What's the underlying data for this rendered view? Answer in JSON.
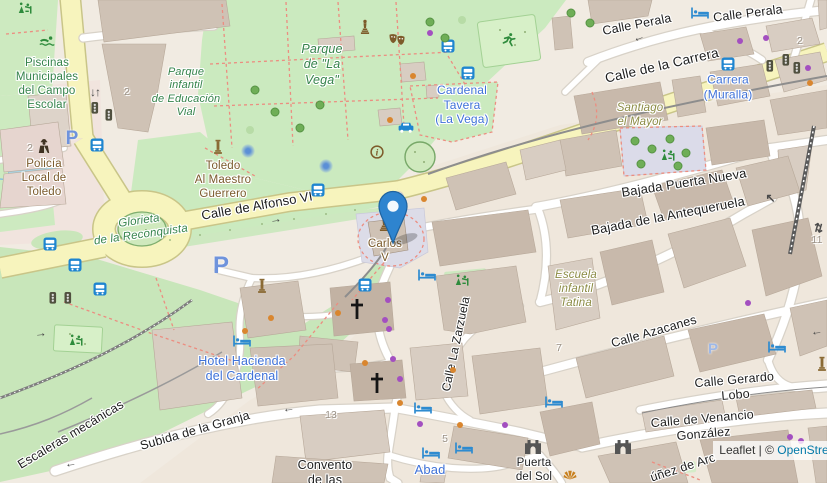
{
  "map": {
    "attribution": {
      "prefix": "Leaflet",
      "sep": " | ",
      "copyright": "© ",
      "link": "OpenStreetMap"
    },
    "marker": {
      "x": 393,
      "y": 243,
      "title": "location-marker"
    },
    "colors": {
      "road_primary": "#f7f4bd",
      "park": "#cbeabf",
      "building": "#d8cdc2",
      "marker_blue": "#2e84cf",
      "label_blue": "#3f72d8",
      "label_green": "#35834b",
      "label_brown": "#7a5a2b",
      "label_olive": "#8b8b44",
      "attribution_link": "#0078a8",
      "bus_icon": "#1e85d0",
      "shop_dot": "#a34fc0",
      "poi_dot": "#d9862f"
    },
    "labels": [
      {
        "t": "Piscinas\nMunicipales\ndel Campo\nEscolar",
        "x": 47,
        "y": 84,
        "c": "gr",
        "s": 11.5
      },
      {
        "t": "Parque\ninfantil\nde Educación\nVial",
        "x": 186,
        "y": 93,
        "c": "gi",
        "s": 11
      },
      {
        "t": "Parque\nde \"La\nVega\"",
        "x": 322,
        "y": 65,
        "c": "gi",
        "s": 12.5
      },
      {
        "t": "Calle Perala",
        "x": 637,
        "y": 25,
        "c": "st",
        "r": -11,
        "s": 12.5
      },
      {
        "t": "Calle Perala",
        "x": 748,
        "y": 14,
        "c": "st",
        "r": -7,
        "s": 12.5
      },
      {
        "t": "Calle de la Carrera",
        "x": 662,
        "y": 66,
        "c": "st",
        "r": -13,
        "s": 13.5
      },
      {
        "t": "Carrera\n(Muralla)",
        "x": 728,
        "y": 87,
        "c": "bl",
        "s": 12
      },
      {
        "t": "Cardenal\nTavera\n(La Vega)",
        "x": 462,
        "y": 105,
        "c": "bl",
        "s": 12
      },
      {
        "t": "Santiago\nel Mayor",
        "x": 640,
        "y": 115,
        "c": "ol",
        "s": 11.5
      },
      {
        "t": "Bajada Puerta Nueva",
        "x": 684,
        "y": 183,
        "c": "st",
        "r": -9,
        "s": 13
      },
      {
        "t": "Bajada de la Antequeruela",
        "x": 668,
        "y": 216,
        "c": "st",
        "r": -11,
        "s": 13
      },
      {
        "t": "Toledo\nAl Maestro\nGuerrero",
        "x": 223,
        "y": 180,
        "c": "br",
        "s": 11.5
      },
      {
        "t": "Calle de Alfonso VI",
        "x": 257,
        "y": 206,
        "c": "st",
        "r": -10,
        "s": 13
      },
      {
        "t": "Glorieta\nde la Reconquista",
        "x": 140,
        "y": 228,
        "c": "gi",
        "r": -8,
        "s": 11.5
      },
      {
        "t": "Policía\nLocal de\nToledo",
        "x": 44,
        "y": 178,
        "c": "br",
        "s": 11.5
      },
      {
        "t": "Carlos\nV",
        "x": 385,
        "y": 251,
        "c": "br",
        "s": 11.5
      },
      {
        "t": "Escuela\ninfantil\nTatina",
        "x": 576,
        "y": 289,
        "c": "ol",
        "s": 11.5
      },
      {
        "t": "Calle La Zarzuela",
        "x": 456,
        "y": 344,
        "c": "st",
        "r": -78,
        "s": 12
      },
      {
        "t": "Calle Azacanes",
        "x": 654,
        "y": 332,
        "c": "st",
        "r": -16,
        "s": 12.5
      },
      {
        "t": "Hotel Hacienda\ndel Cardenal",
        "x": 242,
        "y": 369,
        "c": "bl",
        "s": 12.5
      },
      {
        "t": "Calle Gerardo Lobo",
        "x": 735,
        "y": 388,
        "c": "st",
        "r": -5,
        "s": 12.5
      },
      {
        "t": "Calle de Venancio González",
        "x": 703,
        "y": 427,
        "c": "st",
        "r": -5,
        "s": 12.5
      },
      {
        "t": "Subida de la Granja",
        "x": 195,
        "y": 431,
        "c": "st",
        "r": -16,
        "s": 12.5
      },
      {
        "t": "Escaleras mecánicas",
        "x": 71,
        "y": 435,
        "c": "st",
        "r": -31,
        "s": 12.5
      },
      {
        "t": "Convento\nde las",
        "x": 325,
        "y": 473,
        "c": "st",
        "s": 12.5
      },
      {
        "t": "Abad",
        "x": 430,
        "y": 470,
        "c": "bl",
        "s": 13
      },
      {
        "t": "Puerta\ndel Sol",
        "x": 534,
        "y": 470,
        "c": "st",
        "s": 11.5
      },
      {
        "t": "úñez de Arc",
        "x": 683,
        "y": 468,
        "c": "st",
        "r": -18,
        "s": 12.5
      }
    ],
    "numbers": [
      {
        "t": "2",
        "x": 127,
        "y": 92
      },
      {
        "t": "2",
        "x": 30,
        "y": 148
      },
      {
        "t": "2",
        "x": 800,
        "y": 41
      },
      {
        "t": "13",
        "x": 331,
        "y": 415
      },
      {
        "t": "5",
        "x": 445,
        "y": 439
      },
      {
        "t": "7",
        "x": 559,
        "y": 348
      },
      {
        "t": "11",
        "x": 817,
        "y": 240
      }
    ],
    "icons": {
      "bus-stop": [
        [
          97,
          145
        ],
        [
          50,
          244
        ],
        [
          75,
          265
        ],
        [
          100,
          289
        ],
        [
          448,
          46
        ],
        [
          468,
          73
        ],
        [
          318,
          190
        ],
        [
          728,
          64
        ],
        [
          365,
          285
        ]
      ],
      "hotel": [
        [
          700,
          13
        ],
        [
          242,
          341
        ],
        [
          427,
          275
        ],
        [
          423,
          408
        ],
        [
          431,
          453
        ],
        [
          464,
          448
        ],
        [
          777,
          347
        ],
        [
          554,
          402
        ]
      ],
      "taxi": [
        [
          406,
          127
        ]
      ],
      "traffic-signals": [
        [
          95,
          108
        ],
        [
          109,
          115
        ],
        [
          53,
          298
        ],
        [
          68,
          298
        ],
        [
          770,
          66
        ],
        [
          786,
          60
        ],
        [
          797,
          68
        ]
      ],
      "church": [
        [
          357,
          309
        ],
        [
          377,
          383
        ]
      ],
      "city-gate": [
        [
          533,
          447
        ],
        [
          623,
          447
        ]
      ],
      "monument": [
        [
          218,
          147
        ],
        [
          262,
          286
        ],
        [
          822,
          364
        ]
      ],
      "statue": [
        [
          365,
          27
        ],
        [
          384,
          224
        ]
      ],
      "theatre": [
        [
          397,
          40
        ]
      ],
      "running": [
        [
          509,
          40
        ]
      ],
      "swimming": [
        [
          47,
          41
        ]
      ],
      "police": [
        [
          44,
          146
        ]
      ],
      "information": [
        [
          377,
          152
        ]
      ],
      "playground": [
        [
          668,
          155
        ],
        [
          462,
          280
        ],
        [
          76,
          340
        ],
        [
          25,
          8
        ]
      ],
      "viewpoint": [
        [
          570,
          475
        ]
      ],
      "fountain": [
        [
          248,
          151
        ],
        [
          326,
          166
        ]
      ]
    },
    "parkings": [
      {
        "x": 221,
        "y": 266,
        "s": 24
      },
      {
        "x": 72,
        "y": 139,
        "s": 19
      },
      {
        "x": 713,
        "y": 349,
        "s": 15
      }
    ],
    "arrows": [
      {
        "ch": "←",
        "x": 638,
        "y": 37,
        "r": -20
      },
      {
        "ch": "←",
        "x": 288,
        "y": 408,
        "r": -6
      },
      {
        "ch": "←",
        "x": 70,
        "y": 463,
        "r": -8
      },
      {
        "ch": "←",
        "x": 816,
        "y": 331,
        "r": -8
      },
      {
        "ch": "→",
        "x": 275,
        "y": 219,
        "r": -9
      },
      {
        "ch": "→",
        "x": 40,
        "y": 333,
        "r": -6
      },
      {
        "ch": "↖",
        "x": 770,
        "y": 198,
        "r": 0
      },
      {
        "ch": "↓↑",
        "x": 95,
        "y": 92,
        "r": 0
      },
      {
        "ch": "⇅",
        "x": 818,
        "y": 228,
        "r": 15
      }
    ],
    "dots": {
      "purple": [
        [
          430,
          33
        ],
        [
          740,
          41
        ],
        [
          766,
          38
        ],
        [
          808,
          68
        ],
        [
          388,
          300
        ],
        [
          385,
          320
        ],
        [
          389,
          329
        ],
        [
          393,
          359
        ],
        [
          400,
          379
        ],
        [
          420,
          424
        ],
        [
          505,
          425
        ],
        [
          748,
          303
        ],
        [
          790,
          437
        ],
        [
          801,
          441
        ]
      ],
      "orange": [
        [
          424,
          199
        ],
        [
          338,
          313
        ],
        [
          245,
          331
        ],
        [
          271,
          318
        ],
        [
          365,
          363
        ],
        [
          453,
          370
        ],
        [
          460,
          425
        ],
        [
          400,
          403
        ],
        [
          810,
          83
        ],
        [
          413,
          76
        ],
        [
          390,
          120
        ]
      ],
      "trees": [
        [
          635,
          141
        ],
        [
          652,
          149
        ],
        [
          670,
          139
        ],
        [
          686,
          153
        ],
        [
          641,
          164
        ],
        [
          678,
          166
        ],
        [
          571,
          13
        ],
        [
          590,
          23
        ],
        [
          255,
          90
        ],
        [
          275,
          112
        ],
        [
          300,
          128
        ],
        [
          320,
          105
        ],
        [
          430,
          22
        ],
        [
          445,
          38
        ]
      ]
    }
  }
}
